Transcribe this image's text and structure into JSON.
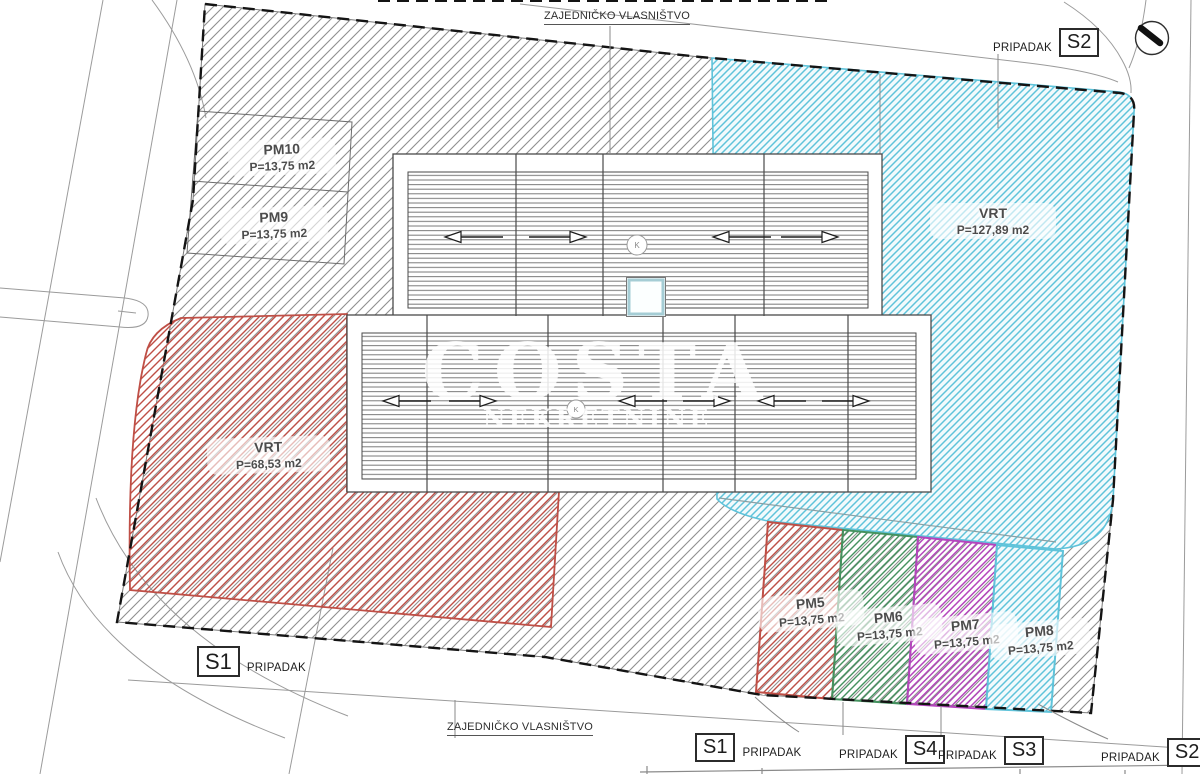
{
  "boundary_labels": {
    "top": "ZAJEDNIČKO VLASNIŠTVO",
    "bottom": "ZAJEDNIČKO VLASNIŠTVO"
  },
  "pripadak_label": "PRIPADAK",
  "unit_tags": {
    "top_right_unit": "S2",
    "left_unit": "S1",
    "bottom": [
      {
        "unit": "S1"
      },
      {
        "unit": "S4"
      },
      {
        "unit": "S3"
      },
      {
        "unit": "S2"
      }
    ]
  },
  "parcels": {
    "pm10": {
      "name": "PM10",
      "area": "P=13,75 m2"
    },
    "pm9": {
      "name": "PM9",
      "area": "P=13,75 m2"
    },
    "pm5": {
      "name": "PM5",
      "area": "P=13,75 m2"
    },
    "pm6": {
      "name": "PM6",
      "area": "P=13,75 m2"
    },
    "pm7": {
      "name": "PM7",
      "area": "P=13,75 m2"
    },
    "pm8": {
      "name": "PM8",
      "area": "P=13,75 m2"
    },
    "vrt_left": {
      "name": "VRT",
      "area": "P=68,53 m2"
    },
    "vrt_right": {
      "name": "VRT",
      "area": "P=127,89 m2"
    }
  },
  "watermark": {
    "line1": "COSTA",
    "line2": "NEKRETNINE"
  },
  "roof_marks": {
    "vent": "K"
  },
  "colors": {
    "gray": "#8f8f8f",
    "cyan": "#5fc3da",
    "red": "#bf4f46",
    "green": "#44925f",
    "magenta": "#b545bd"
  }
}
